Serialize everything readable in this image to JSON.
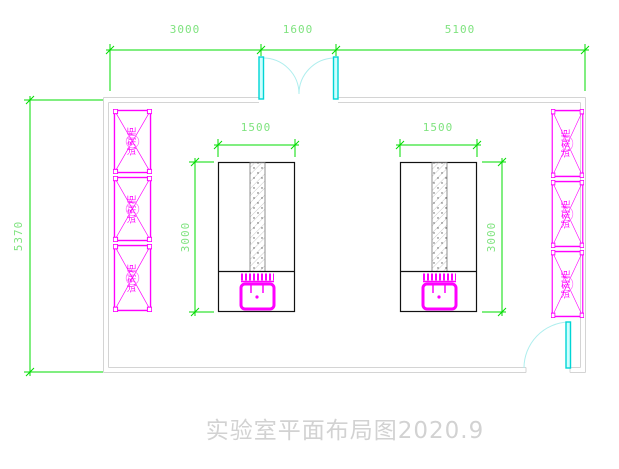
{
  "title": "实验室平面布局图2020.9",
  "room": {
    "dimensions": {
      "top_segments": [
        "3000",
        "1600",
        "5100"
      ],
      "height": "5370"
    }
  },
  "benches": {
    "width_label": "1500",
    "depth_label": "3000"
  },
  "cabinets": {
    "label": "试剂柜",
    "left_count": 3,
    "right_count": 3
  },
  "colors": {
    "dimension_green": "#00dc00",
    "dimension_text_green": "#7fe37f",
    "cabinet_magenta": "#ff00ff",
    "door_cyan": "#00e0e0",
    "door_arc_cyan": "#aeeeee",
    "wall_gray": "#d4d4d4",
    "bench_black": "#111111",
    "title_gray": "#d2d2d2"
  }
}
